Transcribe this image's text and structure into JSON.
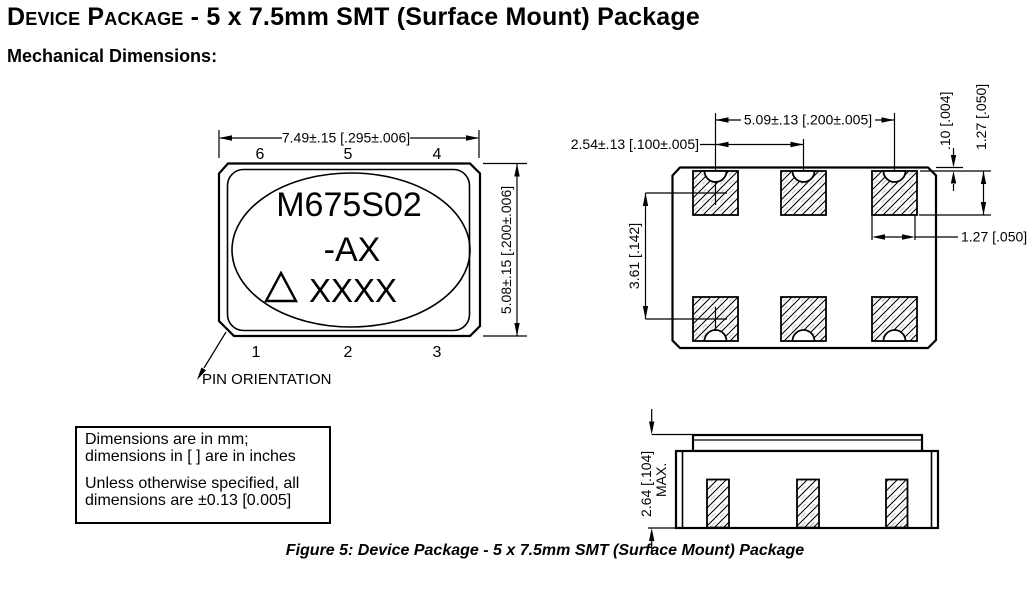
{
  "header": {
    "title_smallcaps": "Device Package",
    "title_rest": " - 5 x 7.5mm SMT (Surface Mount) Package",
    "subtitle": "Mechanical Dimensions:"
  },
  "top_view": {
    "marking_line1": "M675S02",
    "marking_line2": "-AX",
    "marking_line3": "XXXX",
    "width_dim": "7.49±.15 [.295±.006]",
    "height_dim": "5.08±.15 [.200±.006]",
    "pins_top": [
      "6",
      "5",
      "4"
    ],
    "pins_bottom": [
      "1",
      "2",
      "3"
    ],
    "pin_orientation_label": "PIN ORIENTATION"
  },
  "land_pattern": {
    "pad_pitch_dim": "2.54±.13 [.100±.005]",
    "pad_span_dim": "5.09±.13 [.200±.005]",
    "edge_offset_dim": ".10 [.004]",
    "pad_height_dim": "1.27 [.050]",
    "pad_width_dim": "1.27 [.050]",
    "row_spacing_dim": "3.61 [.142]"
  },
  "side_view": {
    "max_height_dim": "2.64 [.104]",
    "max_label": "MAX."
  },
  "notes": {
    "para1_line1": "Dimensions are in mm;",
    "para1_line2": "dimensions in [ ] are in inches",
    "para2_line1": "Unless otherwise specified, all",
    "para2_line2": "dimensions are ±0.13 [0.005]"
  },
  "caption": "Figure 5: Device Package - 5 x 7.5mm SMT (Surface Mount) Package"
}
